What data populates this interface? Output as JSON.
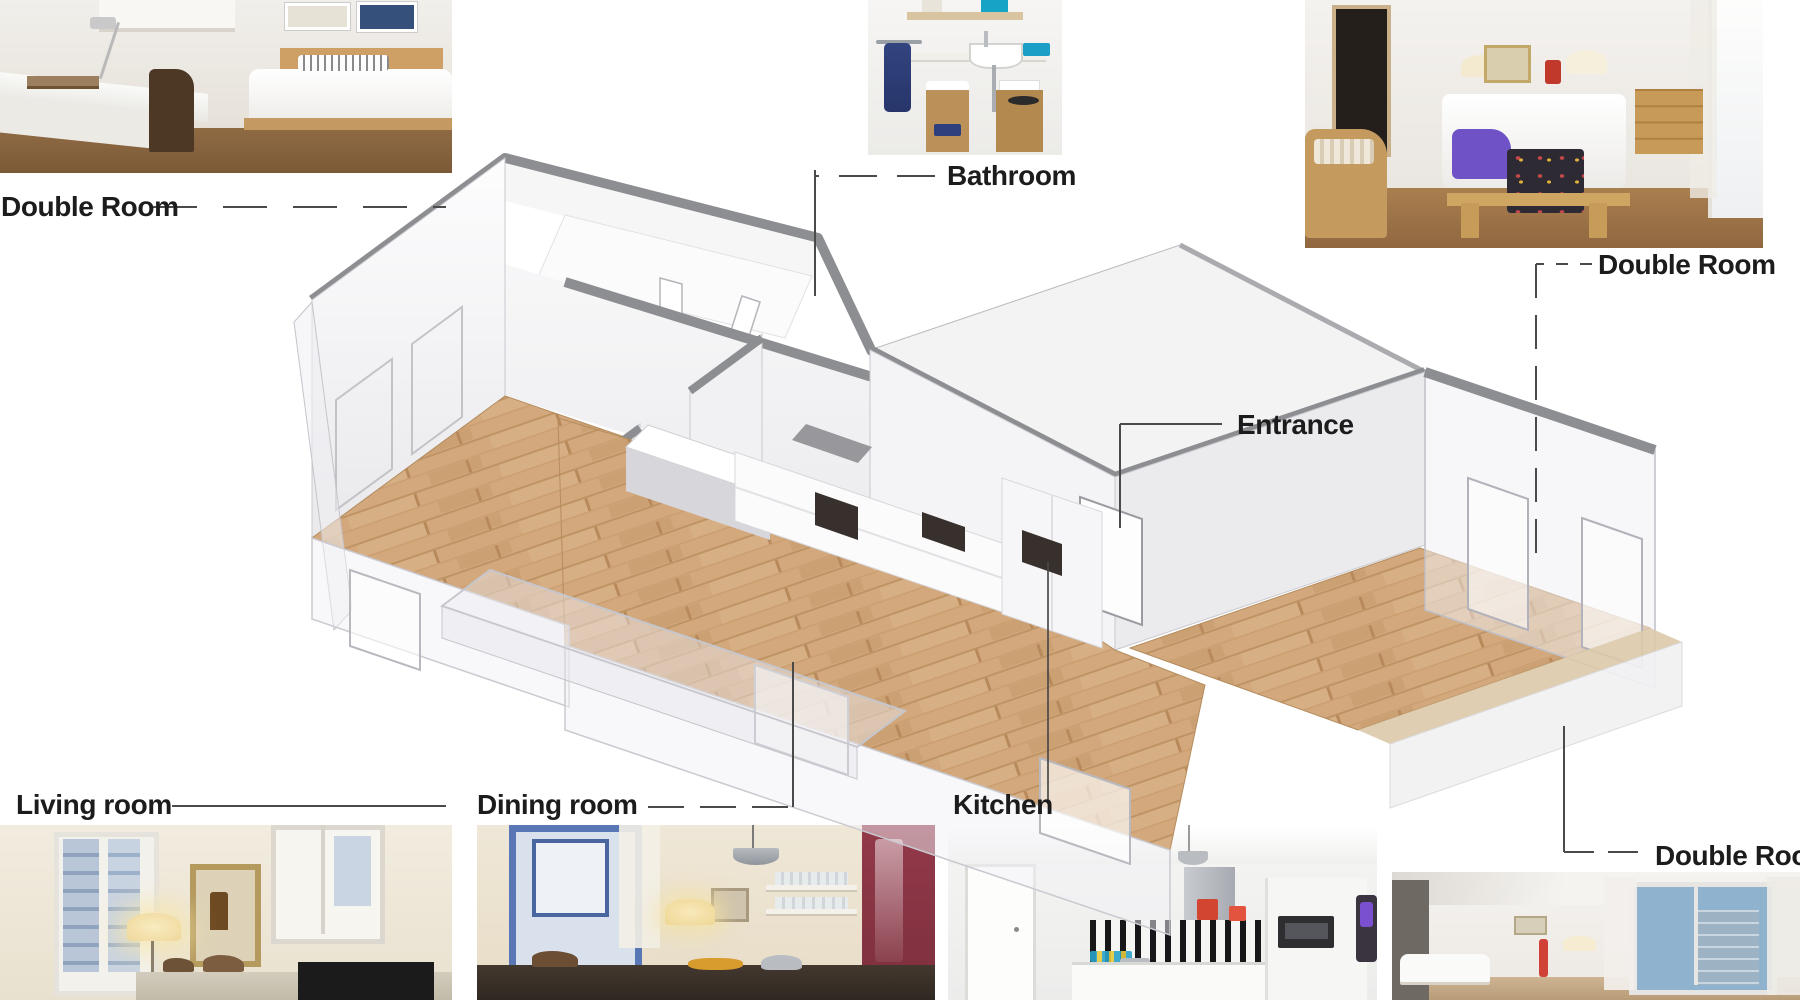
{
  "page": {
    "title": "Apartment isometric floor plan with room photos",
    "background": "#ffffff",
    "width": 1800,
    "height": 1000
  },
  "labels": {
    "double_room_top_left": "Double Room",
    "bathroom": "Bathroom",
    "double_room_top_right": "Double Room",
    "entrance": "Entrance",
    "living_room": "Living room",
    "dining_room": "Dining room",
    "kitchen": "Kitchen",
    "double_room_bottom_right": "Double Room"
  },
  "floor_plan": {
    "type": "isometric-cutaway-apartment",
    "rooms": [
      "Double Room",
      "Bathroom",
      "Entrance",
      "Double Room",
      "Kitchen",
      "Dining room",
      "Living room"
    ],
    "floor_material": "wood planks",
    "colors": {
      "wood_floor": "#d2a87c",
      "wall_top_band": "#8d8e92",
      "wall_face": "#f2f2f4",
      "glass_wall": "rgba(240,240,244,0.5)",
      "balcony": "#e9e9ee",
      "terrace_edge": "#dbc9a8"
    }
  },
  "leaders": {
    "line_color": "#4a4a4a",
    "styles": [
      "dashed",
      "solid"
    ]
  },
  "photos": [
    {
      "name": "double-room-top-left",
      "caption": "Double Room"
    },
    {
      "name": "bathroom",
      "caption": "Bathroom"
    },
    {
      "name": "double-room-top-right",
      "caption": "Double Room"
    },
    {
      "name": "living-room",
      "caption": "Living room"
    },
    {
      "name": "dining-room",
      "caption": "Dining room"
    },
    {
      "name": "kitchen",
      "caption": "Kitchen"
    },
    {
      "name": "double-room-bottom-right",
      "caption": "Double Room"
    }
  ],
  "label_style": {
    "text_color": "#1c1c1c",
    "font_size_px": 28
  }
}
